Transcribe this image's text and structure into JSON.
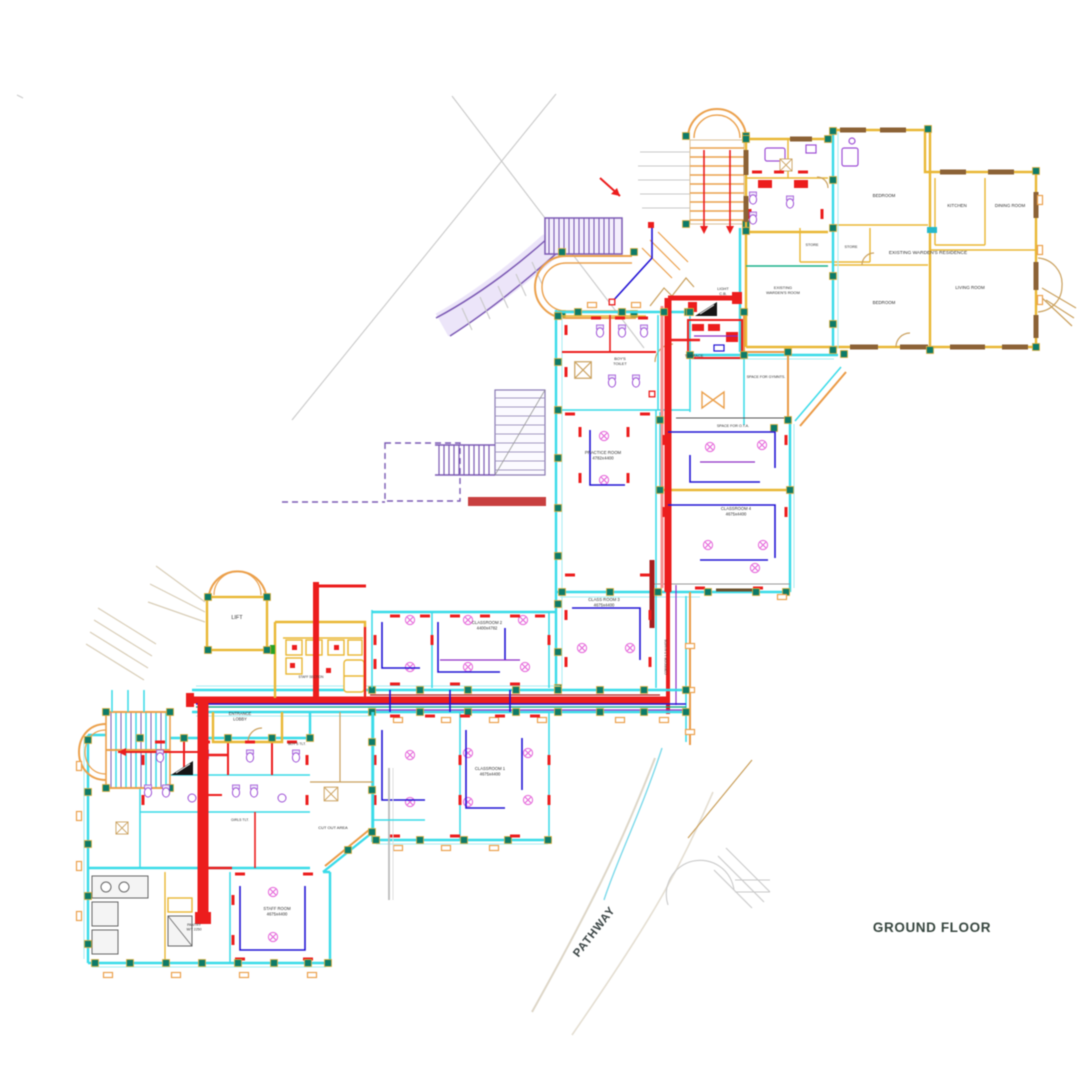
{
  "title": "GROUND FLOOR",
  "colors": {
    "wall_cyan": "#3fd9e6",
    "wall_gold": "#e7b73a",
    "wall_brown": "#8a6238",
    "wall_tan": "#e79a4a",
    "electric_red": "#e41f1f",
    "wiring_blue": "#2214cc",
    "fixture_purple": "#9a4fd0",
    "fan_magenta": "#e26fd8",
    "ramp_purple": "#7a5ab0",
    "column_teal": "#117a68",
    "text": "#2f2f2f",
    "floor_text": "#37463f"
  },
  "labels": [
    {
      "id": "ground-floor",
      "x": 932,
      "y": 932,
      "size": 13.5,
      "bold": true,
      "color": "#37463f",
      "spacing": 0.6,
      "lines": [
        "GROUND FLOOR"
      ]
    },
    {
      "id": "pathway",
      "x": 597,
      "y": 934,
      "size": 11.5,
      "bold": true,
      "rot": -52,
      "color": "#3a4444",
      "spacing": 0.8,
      "lines": [
        "PATHWAY"
      ]
    },
    {
      "id": "residence-title",
      "x": 928,
      "y": 254,
      "size": 4.8,
      "lines": [
        "EXISTING WARDEN'S RESIDENCE"
      ]
    },
    {
      "id": "bedroom-1",
      "x": 884,
      "y": 197,
      "size": 4.4,
      "lines": [
        "BEDROOM"
      ]
    },
    {
      "id": "kitchen",
      "x": 957,
      "y": 207,
      "size": 4.4,
      "lines": [
        "KITCHEN"
      ]
    },
    {
      "id": "dining-room",
      "x": 1010,
      "y": 207,
      "size": 4.4,
      "lines": [
        "DINING ROOM"
      ]
    },
    {
      "id": "living-room",
      "x": 970,
      "y": 289,
      "size": 4.4,
      "lines": [
        "LIVING ROOM"
      ]
    },
    {
      "id": "bedroom-2",
      "x": 884,
      "y": 304,
      "size": 4.4,
      "lines": [
        "BEDROOM"
      ]
    },
    {
      "id": "store-1",
      "x": 812,
      "y": 246,
      "size": 3.8,
      "lines": [
        "STORE"
      ]
    },
    {
      "id": "store-2",
      "x": 851,
      "y": 248,
      "size": 3.8,
      "lines": [
        "STORE"
      ]
    },
    {
      "id": "wardens-room",
      "x": 783,
      "y": 289,
      "size": 3.9,
      "lines": [
        "EXISTING",
        "WARDEN'S ROOM"
      ]
    },
    {
      "id": "light-cb",
      "x": 723,
      "y": 290,
      "size": 3.9,
      "lines": [
        "LIGHT",
        "C.B."
      ]
    },
    {
      "id": "boys-toilet",
      "x": 620,
      "y": 360,
      "size": 3.9,
      "lines": [
        "BOY'S",
        "TOILET"
      ]
    },
    {
      "id": "terrace",
      "x": 694,
      "y": 357,
      "size": 3.9,
      "lines": [
        "TERRACE"
      ]
    },
    {
      "id": "space-gym",
      "x": 766,
      "y": 378,
      "size": 3.7,
      "lines": [
        "SPACE FOR GYMNTS."
      ]
    },
    {
      "id": "space-ota",
      "x": 733,
      "y": 427,
      "size": 3.7,
      "lines": [
        "SPACE FOR O.T.A."
      ]
    },
    {
      "id": "practice-room",
      "x": 603,
      "y": 454,
      "size": 4.3,
      "lines": [
        "PRACTICE ROOM",
        "4782x4400"
      ]
    },
    {
      "id": "classroom-4",
      "x": 736,
      "y": 510,
      "size": 4.2,
      "lines": [
        "CLASSROOM 4",
        "4675x4400"
      ]
    },
    {
      "id": "classroom-3",
      "x": 604,
      "y": 601,
      "size": 4.2,
      "lines": [
        "CLASS ROOM 3",
        "4675x4400"
      ]
    },
    {
      "id": "classroom-2",
      "x": 487,
      "y": 624,
      "size": 4.2,
      "lines": [
        "CLASSROOM 2",
        "4400x4782"
      ]
    },
    {
      "id": "classroom-1",
      "x": 490,
      "y": 770,
      "size": 4.2,
      "lines": [
        "CLASSROOM 1",
        "4675x4400"
      ]
    },
    {
      "id": "staff-room",
      "x": 277,
      "y": 910,
      "size": 4.2,
      "lines": [
        "STAFF ROOM",
        "4675x4400"
      ]
    },
    {
      "id": "cut-out-area",
      "x": 333,
      "y": 829,
      "size": 4,
      "lines": [
        "CUT OUT AREA"
      ]
    },
    {
      "id": "entrance-lobby",
      "x": 240,
      "y": 715,
      "size": 4.1,
      "lines": [
        "ENTRANCE",
        "LOBBY"
      ]
    },
    {
      "id": "lift",
      "x": 237,
      "y": 619,
      "size": 5.5,
      "lines": [
        "LIFT"
      ]
    },
    {
      "id": "pantry",
      "x": 194,
      "y": 926,
      "size": 3.5,
      "lines": [
        "PANTRY",
        "W/T 2250"
      ]
    },
    {
      "id": "girls-tlt",
      "x": 240,
      "y": 821,
      "size": 3.5,
      "lines": [
        "GIRLS TLT."
      ]
    },
    {
      "id": "boys-tlt",
      "x": 297,
      "y": 745,
      "size": 3.5,
      "lines": [
        "BOY'S TLT."
      ]
    },
    {
      "id": "staff-section",
      "x": 311,
      "y": 678,
      "size": 3.2,
      "lines": [
        "STAFF SECTION"
      ]
    },
    {
      "id": "corridor-v",
      "x": 667,
      "y": 657,
      "size": 3.2,
      "rot": -90,
      "lines": [
        "CORRIDOR 1.5 M WIDE"
      ]
    }
  ]
}
